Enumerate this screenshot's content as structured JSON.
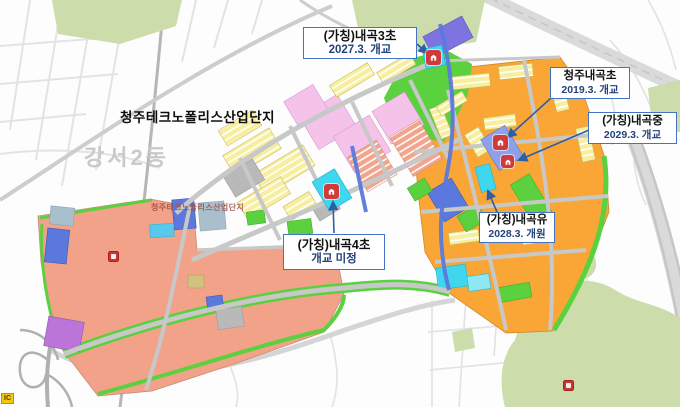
{
  "palette": {
    "background": "#fdfdfd",
    "road_light": "#e3e3e3",
    "road_mid": "#cdcdcd",
    "road_dark": "#b6b6b6",
    "forest": "#cddcab",
    "salmon": "#f2a288",
    "orange": "#f9a636",
    "yellow": "#f7ef9f",
    "pink": "#f5c3ea",
    "green_park": "#5bd13f",
    "cyan_site": "#3fd6ee",
    "cyan_light": "#8ee8f4",
    "blue_block": "#5b79dd",
    "purple_block": "#7d74e0",
    "violet_block": "#bb74d8",
    "lavender": "#8ea0ea",
    "bluegray": "#a9bfcc",
    "khaki": "#d2c27f",
    "gray_block": "#b9b9b9",
    "complex_road": "#c8c8c8",
    "callout_border": "#4472c4",
    "callout_text2": "#25427c",
    "leader": "#2e5fa3",
    "school_icon": "#d13a3a",
    "ic_badge": "#f2c50f"
  },
  "map": {
    "complex_title": "청주테크노폴리스산업단지",
    "district_label": "강서2동",
    "complex_inline_label": "청주테크노폴리스산업단지",
    "ic_badge": "IC"
  },
  "callouts": [
    {
      "id": "naegok3-elementary",
      "name": "(가칭)내곡3초",
      "schedule": "2027.3. 개교"
    },
    {
      "id": "cheongju-naegok-elementary",
      "name": "청주내곡초",
      "schedule": "2019.3. 개교"
    },
    {
      "id": "naegok-middle",
      "name": "(가칭)내곡중",
      "schedule": "2029.3. 개교"
    },
    {
      "id": "naegok-kindergarten",
      "name": "(가칭)내곡유",
      "schedule": "2028.3. 개원"
    },
    {
      "id": "naegok4-elementary",
      "name": "(가칭)내곡4초",
      "schedule": "개교 미정"
    }
  ],
  "icons": {
    "school-marker-icon": "red rounded square with white school building glyph",
    "poi-marker-icon": "red rounded square map marker",
    "interchange-badge": "yellow IC interchange badge"
  }
}
